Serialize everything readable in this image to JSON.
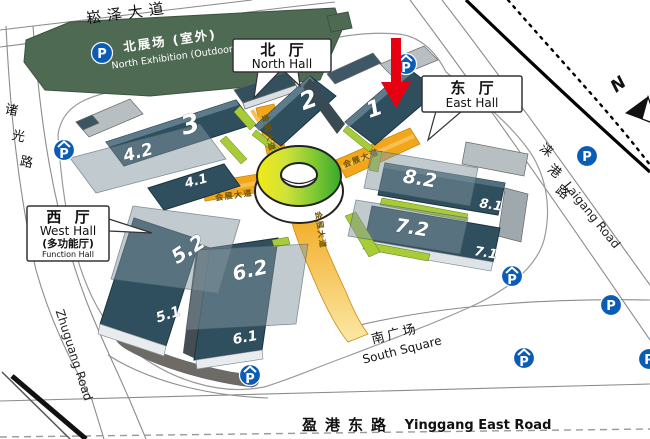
{
  "title": "Exhibition Center Venue Map",
  "colors": {
    "hall_navy": "#2f4f5e",
    "accent_orange": "#f2a71b",
    "strip_green": "#a8cc37",
    "north_exhibition_green": "#4e6a52",
    "parking_blue": "#0a5cb5",
    "arrow_red": "#e60012",
    "ring_yellow": "#f3ea16",
    "ring_green": "#37a82c"
  },
  "roads": {
    "songze_avenue": "崧泽大道",
    "zhuguang_road_chars": [
      "诸",
      "光",
      "路"
    ],
    "zhuguang_road_en": "Zhuguang Road",
    "laigang_road_chars": [
      "涞",
      "港",
      "路"
    ],
    "laigang_road_en": "Laigang Road",
    "yinggang_east_road": "盈港东路",
    "yinggang_east_road_en": "Yinggang East Road",
    "exhibition_avenue": "会展大道"
  },
  "areas": {
    "north_exhibition": "北展场 (室外)",
    "north_exhibition_en": "North Exhibition (Outdoor)",
    "south_square": "南广场",
    "south_square_en": "South Square"
  },
  "callouts": {
    "north_hall": {
      "zh": "北 厅",
      "en": "North Hall"
    },
    "east_hall": {
      "zh": "东 厅",
      "en": "East Hall"
    },
    "west_hall": {
      "zh": "西 厅",
      "en": "West Hall",
      "zh2": "(多功能厅)",
      "en2": "Function Hall"
    }
  },
  "halls": {
    "h1": "1",
    "h2": "2",
    "h3": "3",
    "h4_1": "4.1",
    "h4_2": "4.2",
    "h5_1": "5.1",
    "h5_2": "5.2",
    "h6_1": "6.1",
    "h6_2": "6.2",
    "h7_1": "7.1",
    "h7_2": "7.2",
    "h8_1": "8.1",
    "h8_2": "8.2"
  },
  "compass": "N",
  "parking": {
    "label": "P"
  }
}
